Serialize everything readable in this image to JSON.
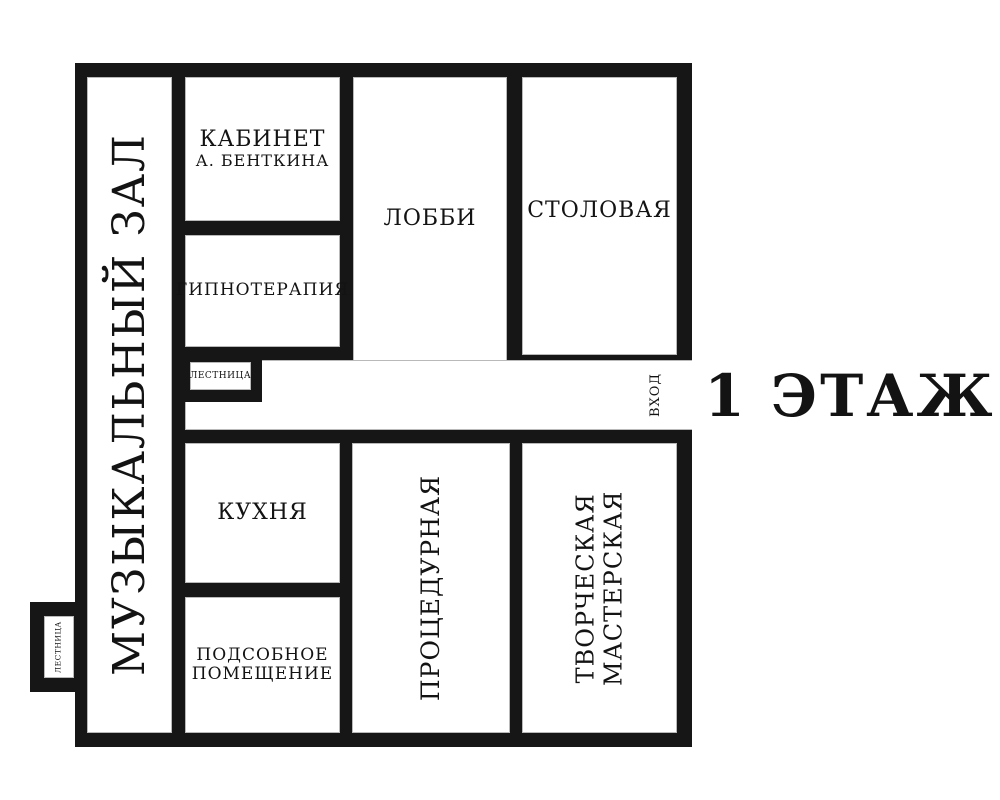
{
  "plan": {
    "floor_title": "1 ЭТАЖ",
    "entrance_label": "ВХОД",
    "colors": {
      "wall": "#161616",
      "background": "#ffffff",
      "text": "#131313"
    },
    "rooms": {
      "music_hall": {
        "label": "МУЗЫКАЛЬНЫЙ ЗАЛ"
      },
      "office": {
        "line1": "КАБИНЕТ",
        "line2": "А. БЕНТКИНА"
      },
      "hypnotherapy": {
        "label": "ГИПНОТЕРАПИЯ"
      },
      "lobby": {
        "label": "ЛОББИ"
      },
      "dining_room": {
        "label": "СТОЛОВАЯ"
      },
      "staircase_upper": {
        "label": "ЛЕСТНИЦА"
      },
      "staircase_lower": {
        "label": "ЛЕСТНИЦА"
      },
      "kitchen": {
        "label": "КУХНЯ"
      },
      "utility_room": {
        "line1": "ПОДСОБНОЕ",
        "line2": "ПОМЕЩЕНИЕ"
      },
      "procedure_room": {
        "label": "ПРОЦЕДУРНАЯ"
      },
      "workshop": {
        "line1": "ТВОРЧЕСКАЯ",
        "line2": "МАСТЕРСКАЯ"
      }
    }
  }
}
